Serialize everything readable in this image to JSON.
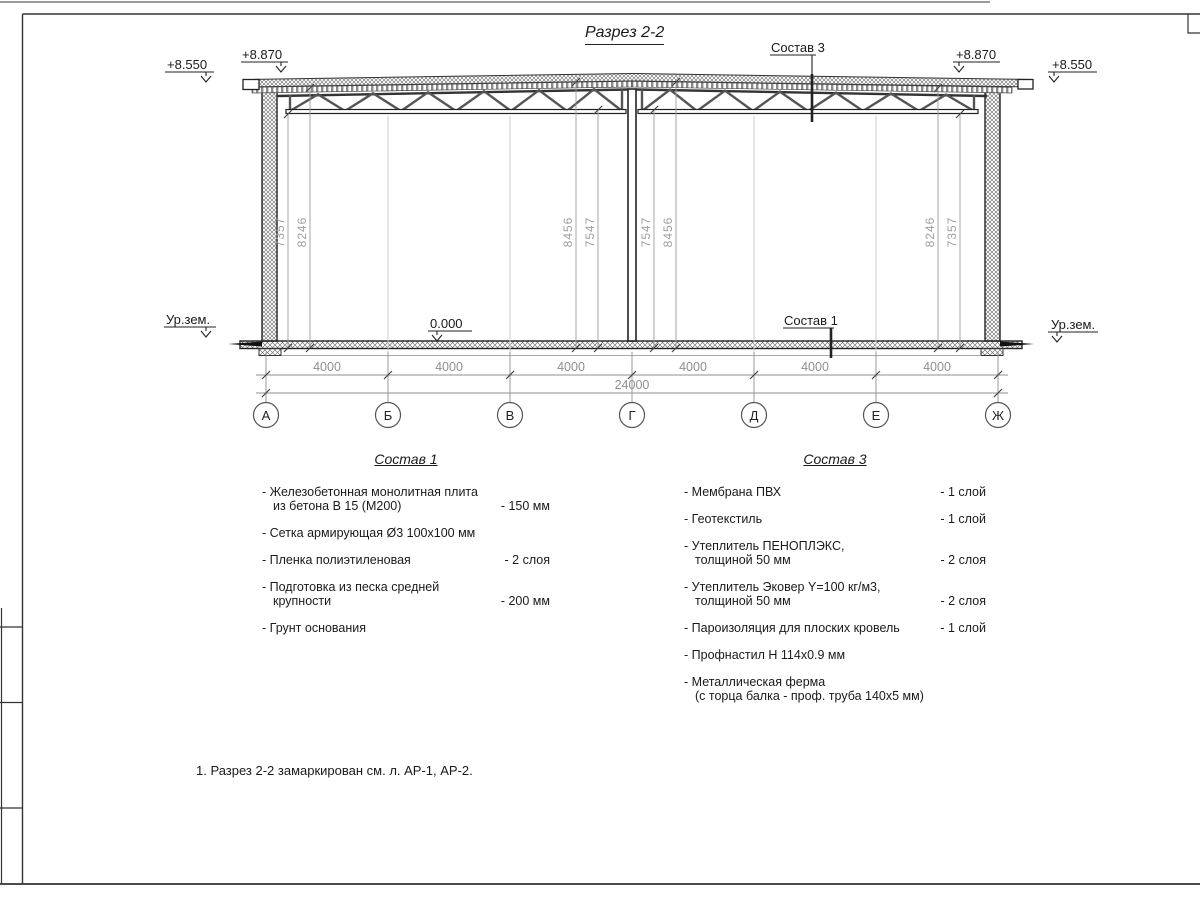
{
  "sheet": {
    "title": "Разрез 2-2",
    "note": "1. Разрез 2-2 замаркирован см. л. АР-1, АР-2."
  },
  "section": {
    "elevations": {
      "left_outer": "+8.550",
      "left_inner": "+8.870",
      "right_inner": "+8.870",
      "right_outer": "+8.550"
    },
    "ground_left": "Ур.зем.",
    "ground_right": "Ур.зем.",
    "floor_level": "0.000",
    "leader_sostav1": "Состав 1",
    "leader_sostav3": "Состав 3",
    "vertical_dims": {
      "left": [
        "7357",
        "8246"
      ],
      "center_left": [
        "8456",
        "7547"
      ],
      "center_right": [
        "7547",
        "8456"
      ],
      "right": [
        "8246",
        "7357"
      ]
    },
    "bottom_dims": {
      "segments": [
        "4000",
        "4000",
        "4000",
        "4000",
        "4000",
        "4000"
      ],
      "total": "24000"
    },
    "axes": [
      "А",
      "Б",
      "В",
      "Г",
      "Д",
      "Е",
      "Ж"
    ]
  },
  "sostav1": {
    "title": "Состав 1",
    "items": [
      {
        "name": "- Железобетонная  монолитная плита\nиз бетона В 15 (М200)",
        "value": "- 150 мм"
      },
      {
        "name": "- Сетка армирующая Ø3 100х100 мм",
        "value": ""
      },
      {
        "name": "- Пленка полиэтиленовая",
        "value": "- 2 слоя"
      },
      {
        "name": "- Подготовка из песка средней\nкрупности",
        "value": "- 200 мм"
      },
      {
        "name": "- Грунт основания",
        "value": ""
      }
    ]
  },
  "sostav3": {
    "title": "Состав 3",
    "items": [
      {
        "name": "- Мембрана ПВХ",
        "value": "- 1 слой"
      },
      {
        "name": "- Геотекстиль",
        "value": "- 1 слой"
      },
      {
        "name": "- Утеплитель ПЕНОПЛЭКС,\nтолщиной 50 мм",
        "value": "- 2 слоя"
      },
      {
        "name": "- Утеплитель Эковер Y=100 кг/м3,\nтолщиной 50 мм",
        "value": "- 2 слоя"
      },
      {
        "name": "- Пароизоляция для плоских кровель",
        "value": "- 1 слой"
      },
      {
        "name": "- Профнастил Н 114х0.9 мм",
        "value": ""
      },
      {
        "name": "- Металлическая ферма\n(с торца балка - проф. труба 140х5 мм)",
        "value": ""
      }
    ]
  }
}
